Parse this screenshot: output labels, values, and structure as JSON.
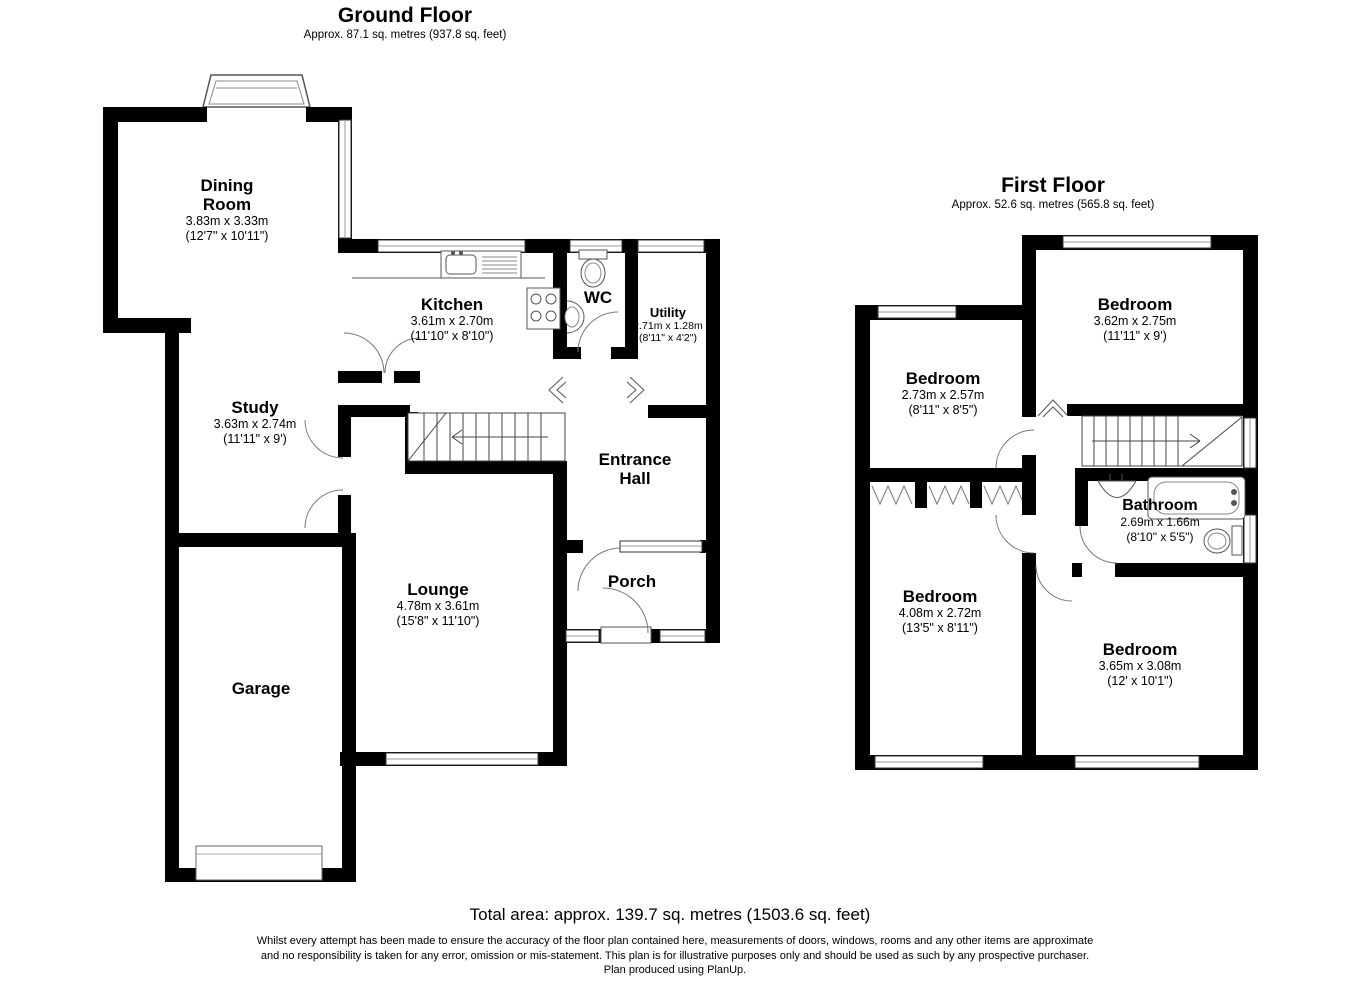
{
  "ground_floor": {
    "title": "Ground Floor",
    "subtitle": "Approx. 87.1 sq. metres (937.8 sq. feet)",
    "rooms": {
      "dining": {
        "l1": "Dining",
        "l2": "Room",
        "dims_m": "3.83m x 3.33m",
        "dims_ft": "(12'7\" x 10'11\")"
      },
      "kitchen": {
        "l1": "Kitchen",
        "dims_m": "3.61m x 2.70m",
        "dims_ft": "(11'10\" x 8'10\")"
      },
      "wc": {
        "l1": "WC"
      },
      "utility": {
        "l1": "Utility",
        "dims_m": "2.71m x 1.28m",
        "dims_ft": "(8'11\" x 4'2\")"
      },
      "study": {
        "l1": "Study",
        "dims_m": "3.63m x 2.74m",
        "dims_ft": "(11'11\" x 9')"
      },
      "entrance_hall": {
        "l1": "Entrance",
        "l2": "Hall"
      },
      "lounge": {
        "l1": "Lounge",
        "dims_m": "4.78m x 3.61m",
        "dims_ft": "(15'8\" x 11'10\")"
      },
      "porch": {
        "l1": "Porch"
      },
      "garage": {
        "l1": "Garage"
      }
    }
  },
  "first_floor": {
    "title": "First Floor",
    "subtitle": "Approx. 52.6 sq. metres (565.8 sq. feet)",
    "rooms": {
      "bedroom_top_right": {
        "l1": "Bedroom",
        "dims_m": "3.62m x 2.75m",
        "dims_ft": "(11'11\" x 9')"
      },
      "bedroom_top_left": {
        "l1": "Bedroom",
        "dims_m": "2.73m x 2.57m",
        "dims_ft": "(8'11\" x 8'5\")"
      },
      "bathroom": {
        "l1": "Bathroom",
        "dims_m": "2.69m x 1.66m",
        "dims_ft": "(8'10\" x 5'5\")"
      },
      "bedroom_bottom_left": {
        "l1": "Bedroom",
        "dims_m": "4.08m x 2.72m",
        "dims_ft": "(13'5\" x 8'11\")"
      },
      "bedroom_bottom_right": {
        "l1": "Bedroom",
        "dims_m": "3.65m x 3.08m",
        "dims_ft": "(12' x 10'1\")"
      }
    }
  },
  "footer": {
    "total_area": "Total area: approx. 139.7 sq. metres (1503.6 sq. feet)",
    "disclaimer_line1": "Whilst every attempt has been made to ensure the accuracy of the floor plan contained here, measurements of doors, windows, rooms and any other items are approximate",
    "disclaimer_line2": "and no responsibility is taken for any error, omission or mis-statement. This plan is for illustrative purposes only and should be used as such by any prospective purchaser.",
    "disclaimer_line3": "Plan produced using PlanUp."
  }
}
